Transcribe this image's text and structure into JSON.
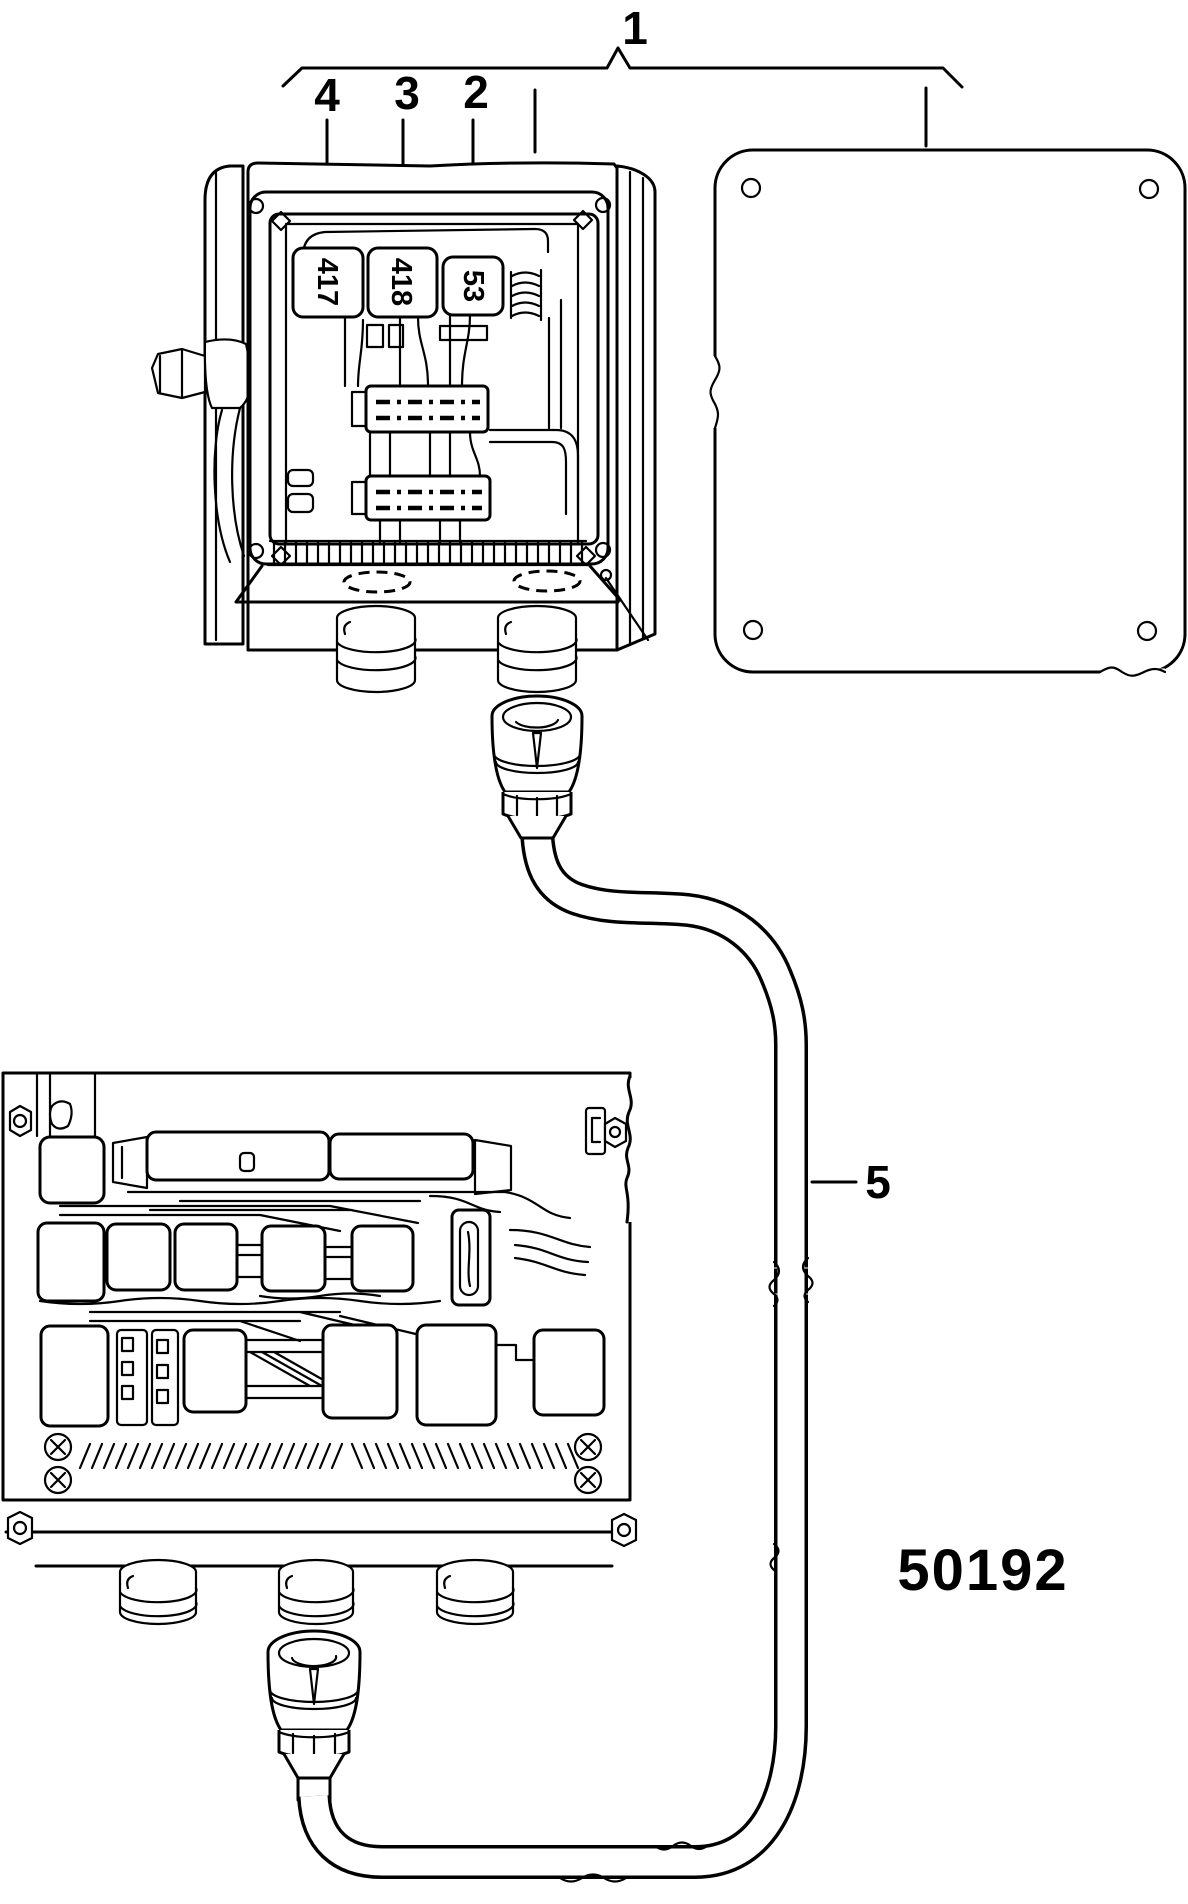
{
  "diagram": {
    "part_number": "50192",
    "callouts": [
      {
        "label": "1"
      },
      {
        "label": "2"
      },
      {
        "label": "3"
      },
      {
        "label": "4"
      },
      {
        "label": "5"
      }
    ],
    "component_labels": [
      {
        "label": "417"
      },
      {
        "label": "418"
      },
      {
        "label": "53"
      }
    ],
    "colors": {
      "line": "#000000",
      "background": "#ffffff"
    }
  }
}
